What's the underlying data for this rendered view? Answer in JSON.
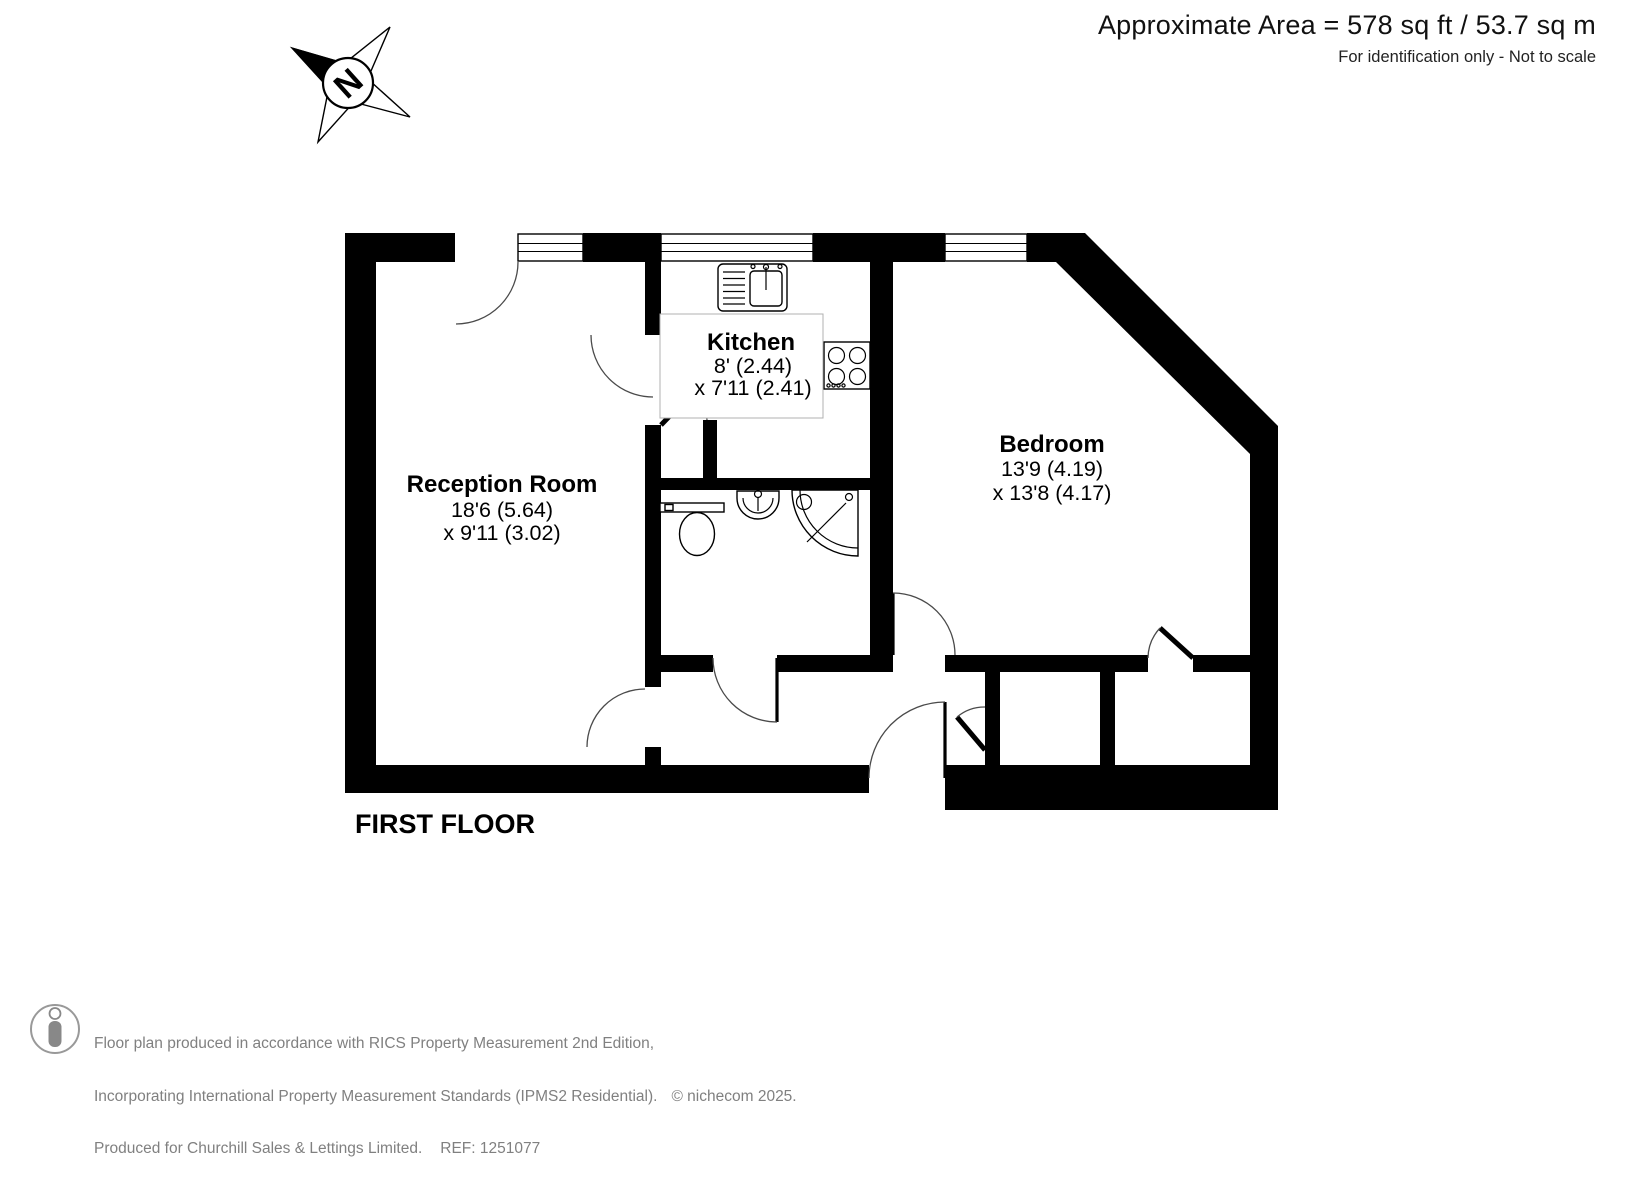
{
  "header": {
    "area_line": "Approximate Area = 578 sq ft / 53.7 sq m",
    "note_line": "For identification only - Not to scale"
  },
  "compass": {
    "label": "N"
  },
  "plan": {
    "floor_label": "FIRST FLOOR",
    "rooms": {
      "reception": {
        "name": "Reception Room",
        "dim1": "18'6 (5.64)",
        "dim2": "x 9'11 (3.02)"
      },
      "kitchen": {
        "name": "Kitchen",
        "dim1": "8' (2.44)",
        "dim2": "x 7'11 (2.41)"
      },
      "bedroom": {
        "name": "Bedroom",
        "dim1": "13'9 (4.19)",
        "dim2": "x 13'8 (4.17)"
      }
    }
  },
  "footer": {
    "line1": "Floor plan produced in accordance with RICS Property Measurement 2nd Edition,",
    "line2": "Incorporating International Property Measurement Standards (IPMS2 Residential).",
    "copyright": "© nichecom 2025.",
    "line3": "Produced for Churchill Sales & Lettings Limited.",
    "ref": "REF: 1251077"
  },
  "icons": {
    "compass": "compass-rose-icon",
    "logo": "person-logo-icon",
    "fixtures": [
      "kitchen-sink-icon",
      "hob-icon",
      "toilet-icon",
      "wash-basin-icon",
      "shower-icon"
    ]
  },
  "colors": {
    "wall": "#000000",
    "muted_text": "#808080",
    "label_box_border": "#b0b0b0"
  }
}
